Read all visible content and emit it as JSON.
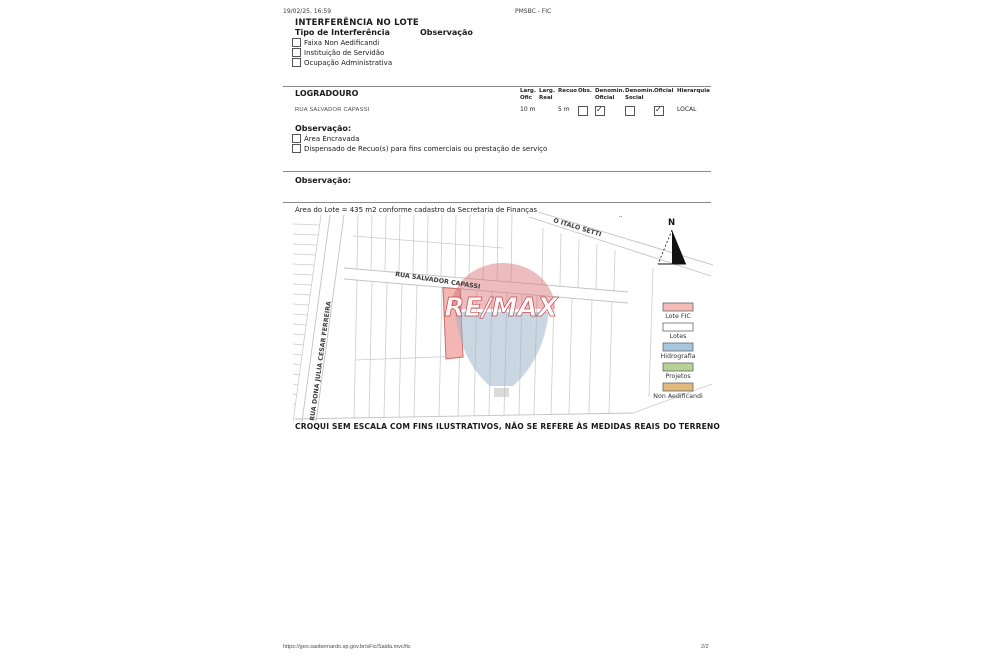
{
  "header": {
    "datetime": "19/02/25, 16:59",
    "app_title": "PMSBC - FIC"
  },
  "interferencia": {
    "title": "INTERFERÊNCIA NO LOTE",
    "tipo_label": "Tipo de Interferência",
    "observacao_label": "Observação",
    "items": [
      {
        "label": "Faixa Non Aedificandi",
        "checked": false
      },
      {
        "label": "Instituição de Servidão",
        "checked": false
      },
      {
        "label": "Ocupação Administrativa",
        "checked": false
      }
    ]
  },
  "logradouro": {
    "title": "LOGRADOURO",
    "columns": [
      {
        "line1": "Larg.",
        "line2": "Ofic"
      },
      {
        "line1": "Larg.",
        "line2": "Real"
      },
      {
        "line1": "Recuo",
        "line2": ""
      },
      {
        "line1": "Obs.",
        "line2": ""
      },
      {
        "line1": "Denomin.",
        "line2": "Oficial"
      },
      {
        "line1": "Denomin.",
        "line2": "Social"
      },
      {
        "line1": "Oficial",
        "line2": ""
      },
      {
        "line1": "Hierarquia",
        "line2": ""
      }
    ],
    "row": {
      "name": "RUA SALVADOR CAPASSI",
      "larg_ofic": "10 m",
      "larg_real": "",
      "recuo": "5 m",
      "obs": false,
      "denomin_oficial": true,
      "denomin_social": false,
      "oficial": true,
      "hierarquia": "LOCAL"
    }
  },
  "observacao1": {
    "title": "Observação:",
    "items": [
      {
        "label": "Área Encravada",
        "checked": false
      },
      {
        "label": "Dispensado de Recuo(s) para fins comerciais ou prestação de serviço",
        "checked": false
      }
    ]
  },
  "observacao2": {
    "title": "Observação:"
  },
  "area_note": "Área do Lote = 435 m2 conforme cadastro da Secretaria de Finanças",
  "map": {
    "streets": [
      "RUA SALVADOR CAPASSI",
      "RUA DONA  JULIA CESAR FERREIRA",
      "O ITALO SETTI"
    ],
    "edge_mark": "’’",
    "north_label": "N",
    "watermark": "RE/MAX",
    "lot_fill": "#f3b6b2",
    "lot_stroke": "#c86f6d",
    "legend": {
      "items": [
        {
          "label": "Lote FIC",
          "color": "#f4bcb8"
        },
        {
          "label": "Lotes",
          "color": "#ffffff"
        },
        {
          "label": "Hidrografia",
          "color": "#a9c6df"
        },
        {
          "label": "Projetos",
          "color": "#b7d294"
        },
        {
          "label": "Non Aedificandi",
          "color": "#dfba7c"
        }
      ]
    }
  },
  "disclaimer": "CROQUI SEM ESCALA COM FINS ILUSTRATIVOS, NÃO SE REFERE ÀS MEDIDAS REAIS DO TERRENO",
  "footer": {
    "url": "https://geo.saobernardo.sp.gov.br/sFic/Saida.mvc/fic",
    "page": "2/2"
  }
}
